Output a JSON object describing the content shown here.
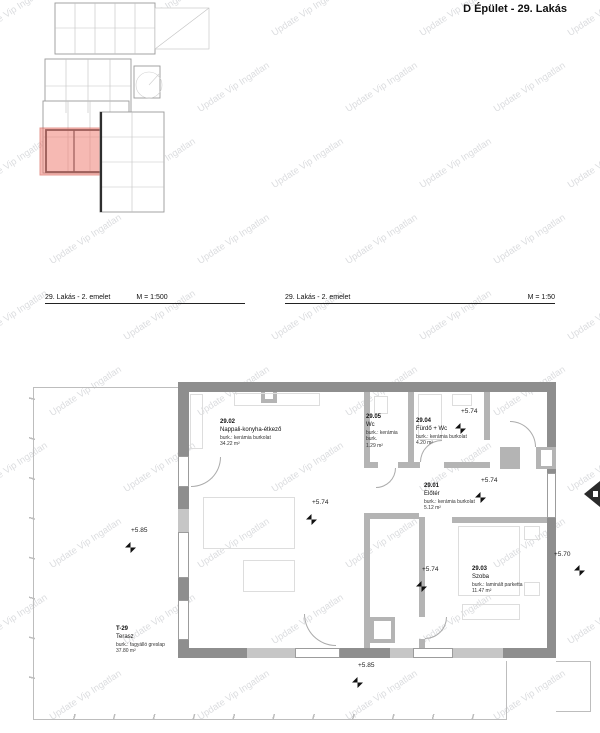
{
  "title": "D Épület - 29. Lakás",
  "watermark": {
    "text": "Update Vip Ingatlan"
  },
  "colors": {
    "wm": "#c6c8cc",
    "line": "#bdbdbd",
    "wall-dark": "#8e8e8e",
    "wall-light": "#b4b4b4",
    "red-fill": "#f08076",
    "red-stroke": "#d0453a"
  },
  "captions": {
    "left": {
      "label": "29. Lakás - 2. emelet",
      "scale": "M = 1:500"
    },
    "right": {
      "label": "29. Lakás - 2. emelet",
      "scale": "M = 1:50"
    }
  },
  "overview": {
    "highlighted_unit": "29. Lakás"
  },
  "plan": {
    "rooms": [
      {
        "id": "29.02",
        "name": "Nappali-konyha-étkező",
        "finish": "burk.: kerámia burkolat",
        "area": "34.22 m²"
      },
      {
        "id": "29.05",
        "name": "Wc",
        "finish": "burk.: kerámia burk.",
        "area": "1.29 m²"
      },
      {
        "id": "29.04",
        "name": "Fürdő + Wc",
        "finish": "burk.: kerámia burkolat",
        "area": "4.20 m²"
      },
      {
        "id": "29.01",
        "name": "Előtér",
        "finish": "burk.: kerámia burkolat",
        "area": "5.12 m²"
      },
      {
        "id": "29.03",
        "name": "Szoba",
        "finish": "burk.: laminált parketta",
        "area": "11.47 m²"
      },
      {
        "id": "T-29",
        "name": "Terasz",
        "finish": "burk.: fagyálló greslap",
        "area": "37.80 m²"
      }
    ],
    "elevations": [
      {
        "label": "+5.74"
      },
      {
        "label": "+5.74"
      },
      {
        "label": "+5.74"
      },
      {
        "label": "+5.85"
      },
      {
        "label": "+5.74"
      },
      {
        "label": "+5.70"
      },
      {
        "label": "+5.85"
      }
    ]
  }
}
